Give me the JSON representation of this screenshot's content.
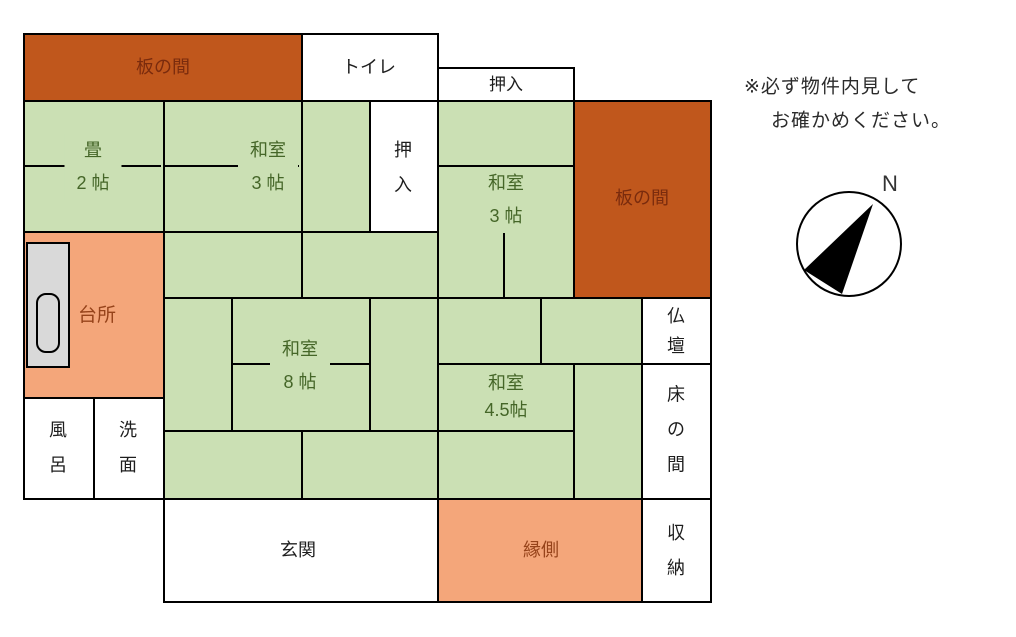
{
  "rooms": {
    "itanoma_top": "板の間",
    "toilet": "トイレ",
    "oshiire_top": "押入",
    "tatami2": {
      "name": "畳",
      "size": "2 帖"
    },
    "washitsu3_left": {
      "name": "和室",
      "size": "3 帖"
    },
    "oshiire_vertical": "押入",
    "washitsu3_right": {
      "name": "和室",
      "size": "3 帖"
    },
    "itanoma_right": "板の間",
    "kitchen": "台所",
    "washitsu8": {
      "name": "和室",
      "size": "8 帖"
    },
    "bath": "風呂",
    "washroom": "洗面",
    "washitsu45": {
      "name": "和室",
      "size": "4.5帖"
    },
    "butsudan": "仏壇",
    "tokonoma": "床の間",
    "genkan": "玄関",
    "engawa": "縁側",
    "shuunou": "収納"
  },
  "note": {
    "line1": "※必ず物件内見して",
    "line2": "お確かめください。"
  },
  "compass": {
    "north_label": "N"
  },
  "colors": {
    "wood_floor_orange": "#C0571C",
    "veranda_salmon": "#F4A67A",
    "tatami_green": "#CBE0B4",
    "appliance_gray": "#D9D9D9",
    "wall_black": "#000000",
    "label_green": "#456628",
    "label_maroon": "#7A2B0D",
    "label_brown": "#96431A"
  }
}
